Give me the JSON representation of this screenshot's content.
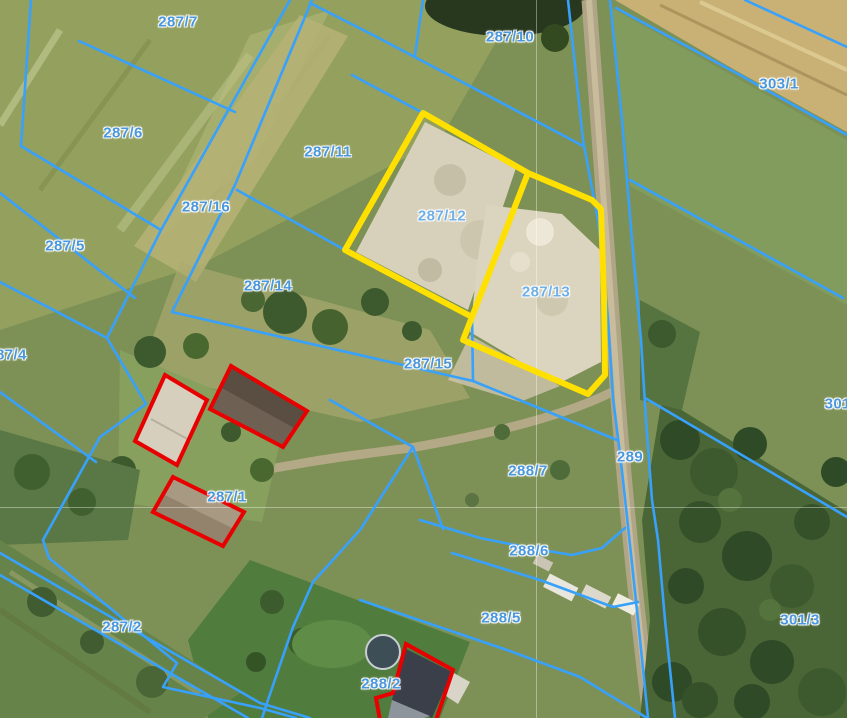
{
  "map": {
    "view": "cadastral-aerial",
    "colors": {
      "parcel_line": "#38a1fb",
      "selected_outline": "#ffe000",
      "building_outline": "#e80000",
      "label": "#4a97dd"
    },
    "selected_parcels": [
      "287/12",
      "287/13"
    ],
    "labels": [
      {
        "text": "287/7"
      },
      {
        "text": "287/10"
      },
      {
        "text": "303/1"
      },
      {
        "text": "287/6"
      },
      {
        "text": "287/11"
      },
      {
        "text": "287/16"
      },
      {
        "text": "287/12"
      },
      {
        "text": "287/5"
      },
      {
        "text": "287/14"
      },
      {
        "text": "287/13"
      },
      {
        "text": "287/4"
      },
      {
        "text": "287/15"
      },
      {
        "text": "301/"
      },
      {
        "text": "289"
      },
      {
        "text": "288/7"
      },
      {
        "text": "287/1"
      },
      {
        "text": "288/6"
      },
      {
        "text": "288/5"
      },
      {
        "text": "287/2"
      },
      {
        "text": "301/3"
      },
      {
        "text": "288/2"
      }
    ]
  }
}
